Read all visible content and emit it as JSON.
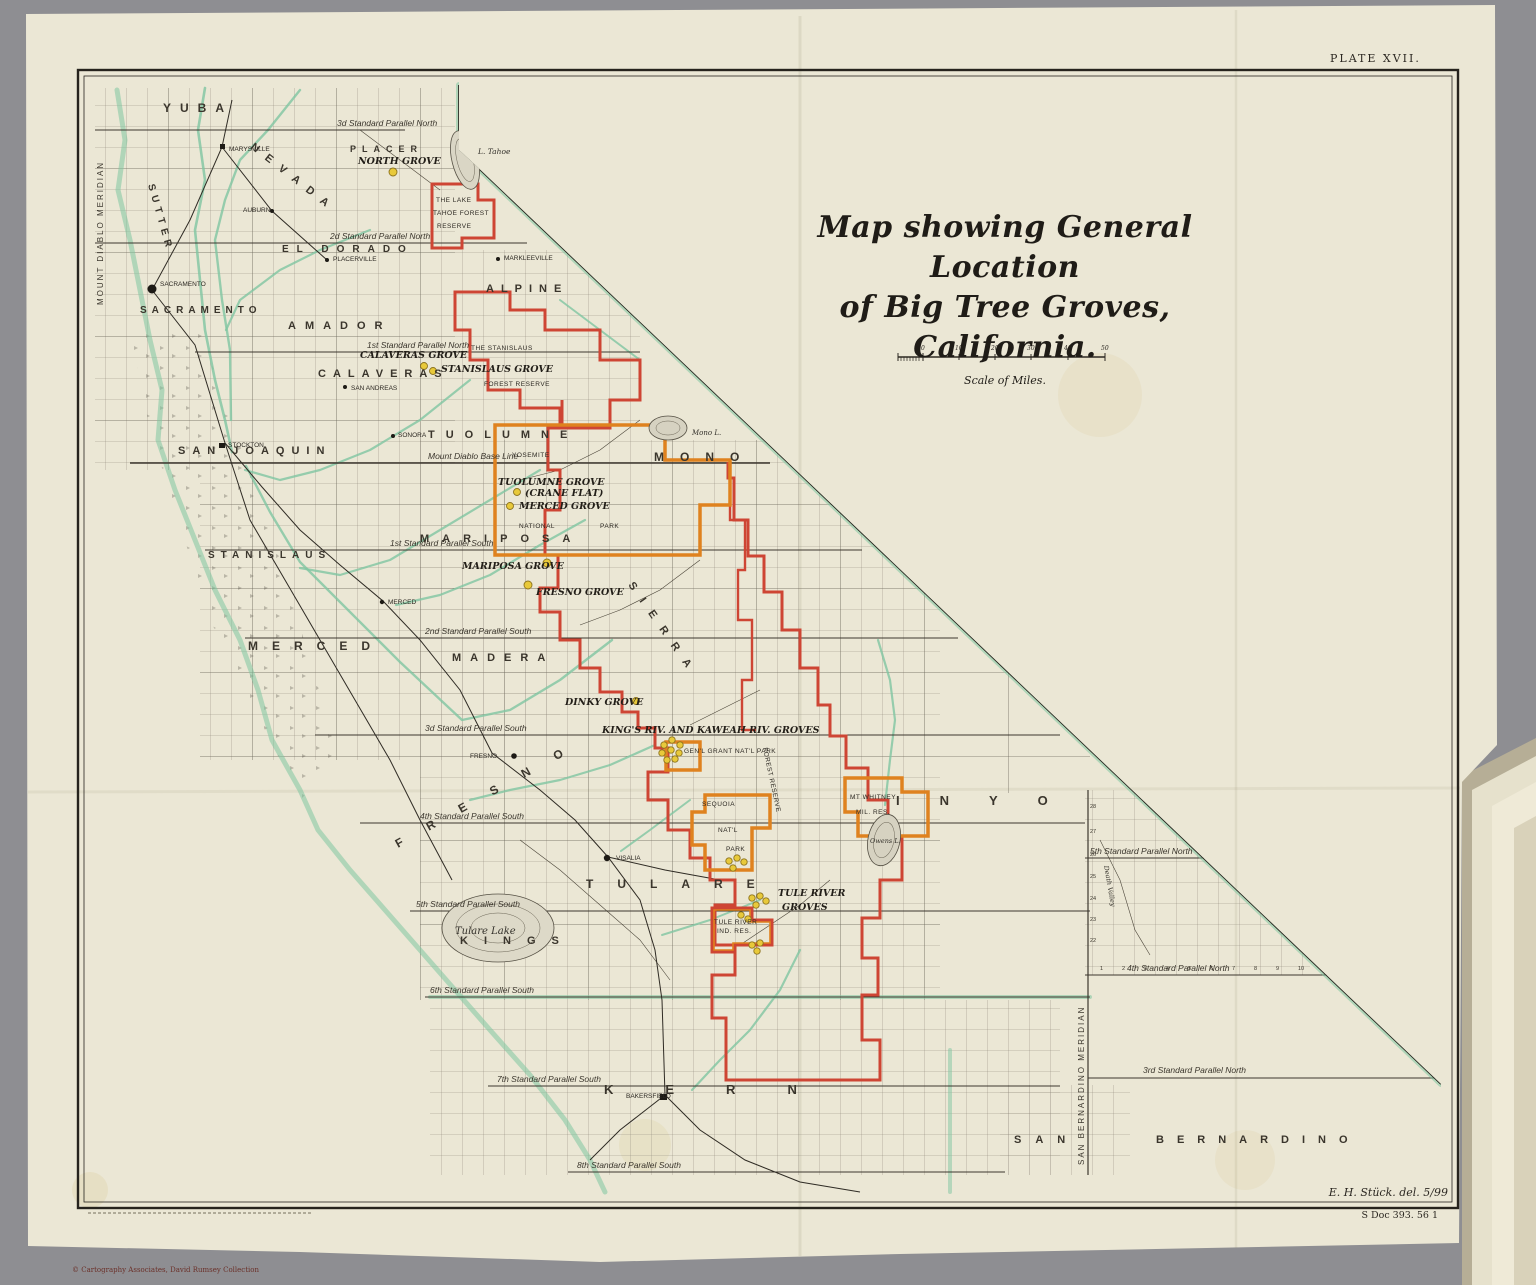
{
  "plate": "PLATE XVII.",
  "title": {
    "line1": "Map showing General Location",
    "line2": "of Big Tree Groves,",
    "line3": "California.",
    "scale_label": "Scale of Miles.",
    "ticks": [
      "0",
      "10",
      "20",
      "30",
      "40",
      "50"
    ]
  },
  "credits": {
    "delineator": "E. H. Stück. del. 5/99",
    "doc": "S Doc 393. 56 1",
    "copyright": "© Cartography Associates, David Rumsey Collection"
  },
  "meridians": {
    "mount_diablo": "MOUNT DIABLO MERIDIAN",
    "san_bernardino": "SAN BERNARDINO MERIDIAN"
  },
  "lines": {
    "base": "Mount Diablo Base Line",
    "p3n": "3d Standard Parallel North",
    "p2n": "2d Standard Parallel North",
    "p1n": "1st Standard Parallel North",
    "p1s": "1st Standard Parallel South",
    "p2s": "2nd Standard Parallel South",
    "p3s": "3d Standard Parallel South",
    "p4s": "4th Standard Parallel South",
    "p5s": "5th Standard Parallel South",
    "p6s": "6th Standard Parallel South",
    "p7s": "7th Standard Parallel South",
    "p8s": "8th Standard Parallel South",
    "p5ne": "5th Standard Parallel North",
    "p4ne": "4th Standard Parallel North",
    "p3ne": "3rd Standard Parallel North"
  },
  "counties": {
    "yuba": "YUBA",
    "sutter": "SUTTER",
    "nevada": "NEVADA",
    "placer": "PLACER",
    "eldorado": "EL DORADO",
    "sacramento": "SACRAMENTO",
    "amador": "AMADOR",
    "alpine": "ALPINE",
    "calaveras": "CALAVERAS",
    "sanjoaquin": "SAN JOAQUIN",
    "stanislaus": "STANISLAUS",
    "tuolumne": "TUOLUMNE",
    "mono": "MONO",
    "mariposa": "MARIPOSA",
    "merced": "MERCED",
    "madera": "MADERA",
    "fresno": "FRESNO",
    "sierra": "SIERRA",
    "tulare": "TULARE",
    "kings": "KINGS",
    "kern": "KERN",
    "inyo": "INYO",
    "san": "SAN",
    "bernardino": "BERNARDINO"
  },
  "reserves": {
    "tahoe1": "THE LAKE",
    "tahoe2": "TAHOE FOREST",
    "tahoe3": "RESERVE",
    "stanislaus1": "THE STANISLAUS",
    "stanislaus2": "FOREST RESERVE",
    "sierra_forest": "FOREST RESERVE",
    "mt_whitney1": "MT WHITNEY",
    "mt_whitney2": "MIL. RES.",
    "tule_res1": "TULE RIVER",
    "tule_res2": "IND. RES."
  },
  "parks": {
    "yosemite": "YOSEMITE",
    "national": "NATIONAL",
    "park": "PARK",
    "gen_grant": "GEN'L GRANT NAT'L PARK",
    "sequoia1": "SEQUOIA",
    "sequoia2": "NAT'L",
    "sequoia3": "PARK"
  },
  "groves": {
    "north": "NORTH GROVE",
    "calaveras": "CALAVERAS GROVE",
    "stanislaus": "STANISLAUS GROVE",
    "tuolumne": "TUOLUMNE GROVE",
    "tuolumne2": "(CRANE FLAT)",
    "merced": "MERCED GROVE",
    "mariposa": "MARIPOSA GROVE",
    "fresno": "FRESNO GROVE",
    "dinky": "DINKY GROVE",
    "kings_kaweah": "KING'S RIV. AND KAWEAH RIV. GROVES",
    "tule1": "TULE RIVER",
    "tule2": "GROVES"
  },
  "towns": {
    "marysville": "MARYSVILLE",
    "auburn": "AUBURN",
    "placerville": "PLACERVILLE",
    "markleeville": "MARKLEEVILLE",
    "sacramento": "SACRAMENTO",
    "stockton": "STOCKTON",
    "san_andreas": "SAN ANDREAS",
    "sonora": "SONORA",
    "merced": "MERCED",
    "fresno": "FRESNO",
    "visalia": "VISALIA",
    "bakersfield": "BAKERSFIELD"
  },
  "lakes": {
    "tahoe": "L. Tahoe",
    "mono": "Mono L.",
    "owens": "Owens L.",
    "tulare": "Tulare Lake"
  },
  "misc": {
    "death_valley": "Death Valley",
    "se_row_numbers": [
      "28",
      "27",
      "26",
      "25",
      "24",
      "23",
      "22"
    ],
    "se_col_numbers": [
      "1",
      "2",
      "3",
      "4",
      "5",
      "6",
      "7",
      "8",
      "9",
      "10"
    ]
  },
  "colors": {
    "reserve_red": "#ce4534",
    "park_orange": "#df821f",
    "water_green": "#7fc6a1",
    "grove_yellow": "#e8c93a",
    "paper": "#ebe7d5"
  }
}
